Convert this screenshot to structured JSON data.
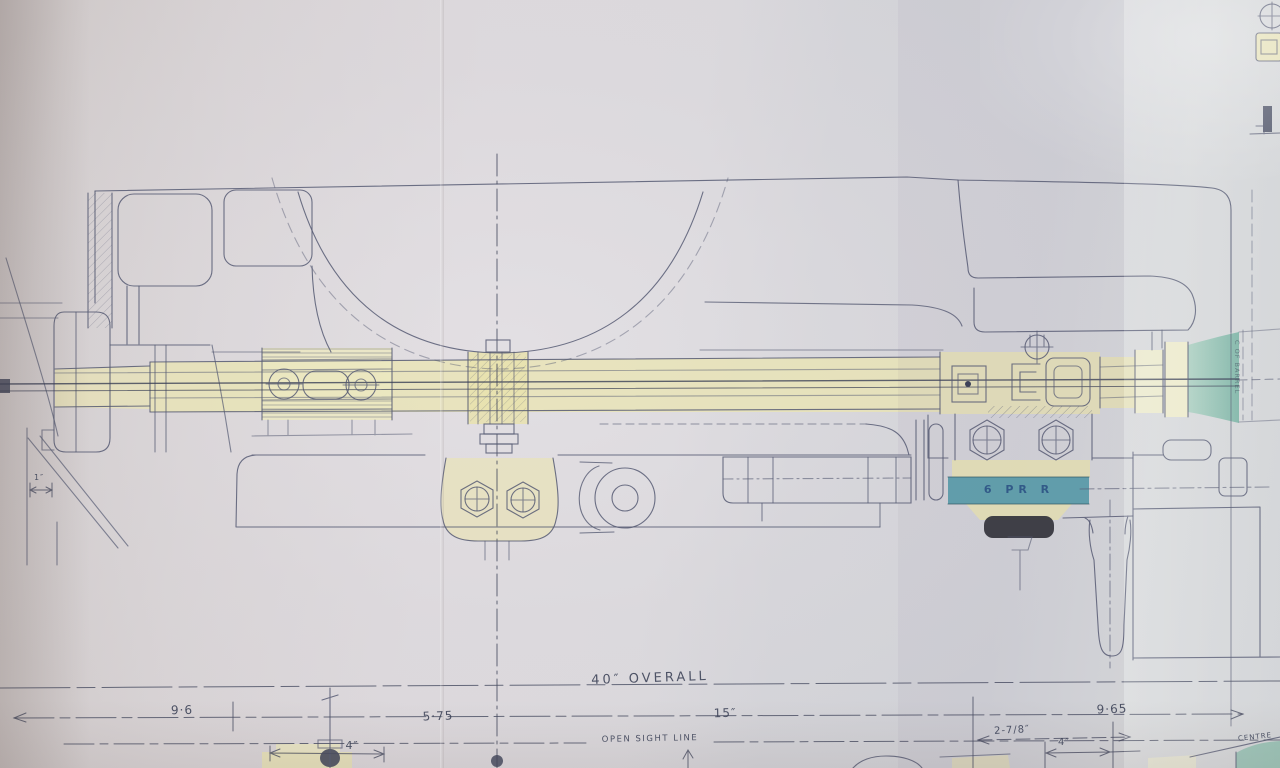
{
  "drawing": {
    "type": "engineering-blueprint-photo",
    "subject": "6 pounder gun — side elevation with overall dimensions"
  },
  "colors": {
    "paper": "#d7d3d5",
    "ink": "#555b73",
    "ink_dark": "#3a4056",
    "brass": "#e9e4b4",
    "brass_light": "#efeccb",
    "teal_band": "#4c98a6",
    "teal_muzzle": "#9cc6b8",
    "knob_black": "#303137",
    "label_ink": "#3b4156",
    "stencil_blue": "#274a80"
  },
  "dimensions": {
    "overall": "40″ OVERALL",
    "seg1": "9·6",
    "seg2": "5·75",
    "seg3": "15″",
    "seg4": "9·65",
    "small_left": "4″",
    "breech_face": "2-7/8″",
    "small_right": "4″",
    "tiny_left": "1″"
  },
  "labels": {
    "open_sight_line": "OPEN SIGHT LINE",
    "calibre_band": "6 PR R",
    "centre_partial": "CENTRE",
    "barrel_axis_note": "C OF BARREL"
  }
}
